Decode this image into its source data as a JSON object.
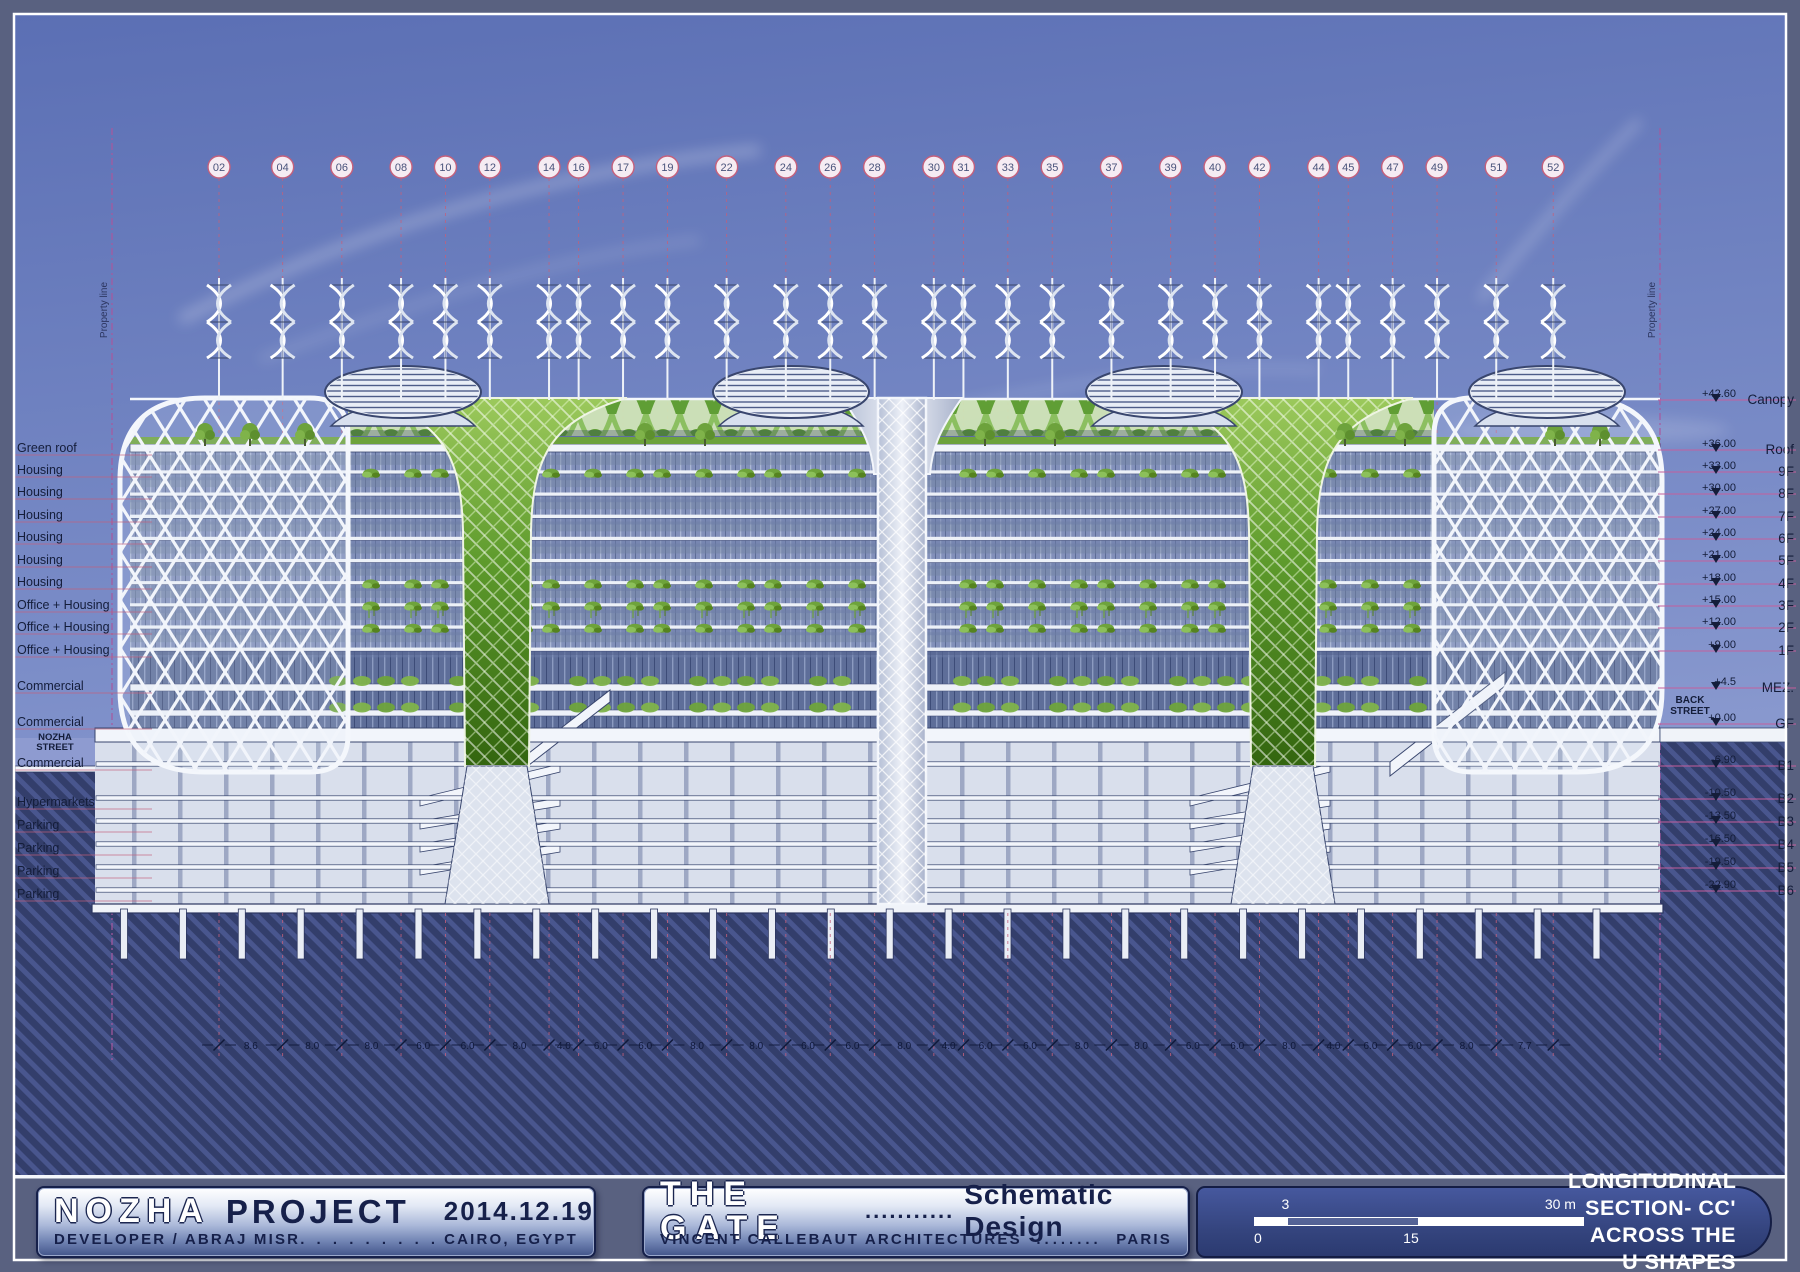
{
  "drawing": {
    "property_line": "Property line",
    "grid_bubbles": [
      "02",
      "04",
      "06",
      "08",
      "10",
      "12",
      "14",
      "16",
      "17",
      "19",
      "22",
      "24",
      "26",
      "28",
      "30",
      "31",
      "33",
      "35",
      "37",
      "39",
      "40",
      "42",
      "44",
      "45",
      "47",
      "49",
      "51",
      "52"
    ],
    "dimensions": [
      "8.6",
      "8.0",
      "8.0",
      "6.0",
      "6.0",
      "8.0",
      "4.0",
      "6.0",
      "6.0",
      "8.0",
      "8.0",
      "6.0",
      "6.0",
      "8.0",
      "4.0",
      "6.0",
      "6.0",
      "8.0",
      "8.0",
      "6.0",
      "6.0",
      "8.0",
      "4.0",
      "6.0",
      "6.0",
      "8.0",
      "7.7"
    ],
    "left_labels": [
      {
        "text": "Green roof",
        "y": 449
      },
      {
        "text": "Housing",
        "y": 471
      },
      {
        "text": "Housing",
        "y": 493
      },
      {
        "text": "Housing",
        "y": 516
      },
      {
        "text": "Housing",
        "y": 538
      },
      {
        "text": "Housing",
        "y": 561
      },
      {
        "text": "Housing",
        "y": 583
      },
      {
        "text": "Office + Housing",
        "y": 606
      },
      {
        "text": "Office + Housing",
        "y": 628
      },
      {
        "text": "Office + Housing",
        "y": 651
      },
      {
        "text": "Commercial",
        "y": 687
      },
      {
        "text": "Commercial",
        "y": 723
      },
      {
        "text": "Commercial",
        "y": 764
      },
      {
        "text": "Hypermarkets",
        "y": 803
      },
      {
        "text": "Parking",
        "y": 826
      },
      {
        "text": "Parking",
        "y": 849
      },
      {
        "text": "Parking",
        "y": 872
      },
      {
        "text": "Parking",
        "y": 895
      }
    ],
    "nozha_street": [
      "NOZHA",
      "STREET"
    ],
    "back_street": [
      "BACK",
      "STREET"
    ],
    "right_levels": [
      {
        "elev": "+42.60",
        "label": "Canopy",
        "y": 400
      },
      {
        "elev": "+36.00",
        "label": "Roof",
        "y": 450
      },
      {
        "elev": "+33.00",
        "label": "9F",
        "y": 472
      },
      {
        "elev": "+30.00",
        "label": "8F",
        "y": 494
      },
      {
        "elev": "+27.00",
        "label": "7F",
        "y": 517
      },
      {
        "elev": "+24.00",
        "label": "6F",
        "y": 539
      },
      {
        "elev": "+21.00",
        "label": "5F",
        "y": 561
      },
      {
        "elev": "+18.00",
        "label": "4F",
        "y": 584
      },
      {
        "elev": "+15.00",
        "label": "3F",
        "y": 606
      },
      {
        "elev": "+12.00",
        "label": "2F",
        "y": 628
      },
      {
        "elev": "+9.00",
        "label": "1F",
        "y": 651
      },
      {
        "elev": "+4.5",
        "label": "MEZ.",
        "y": 688
      },
      {
        "elev": "+0.00",
        "label": "GF",
        "y": 724
      },
      {
        "elev": "-6.90",
        "label": "B1",
        "y": 766
      },
      {
        "elev": "-10.50",
        "label": "B2",
        "y": 799
      },
      {
        "elev": "-13.50",
        "label": "B3",
        "y": 822
      },
      {
        "elev": "-16.50",
        "label": "B4",
        "y": 845
      },
      {
        "elev": "-19.50",
        "label": "B5",
        "y": 868
      },
      {
        "elev": "-22.90",
        "label": "B6",
        "y": 891
      }
    ]
  },
  "title_block": {
    "project": {
      "name_outline": "NOZHA",
      "name_solid": "PROJECT",
      "date": "2014.12.19",
      "line2_left": "DEVELOPER / ABRAJ MISR",
      "line2_dots": ". . . . . . . . . . . . . . . . .",
      "line2_right": "CAIRO, EGYPT"
    },
    "design": {
      "name_outline": "THE GATE",
      "dots": "...........",
      "name_solid": "Schematic Design",
      "line2_left": "VINCENT CALLEBAUT ARCHITECTURES",
      "line2_dots": "........",
      "line2_right": "PARIS"
    },
    "section": {
      "scale_top_left": "3",
      "scale_top_right": "30 m",
      "scale_bottom_left": "0",
      "scale_bottom_mid": "15",
      "title_line1": "LONGITUDINAL SECTION- CC'",
      "title_line2": "ACROSS THE U SHAPES"
    }
  },
  "colors": {
    "sky_top": "#5b6fb4",
    "sky_bottom": "#97a4d6",
    "ground": "#333e6b",
    "ground_stripe": "#4d5b94",
    "grid_pink": "#c4607c",
    "level_magenta": "#c45f9d",
    "green_dark": "#4f8a24",
    "green_light": "#8dc25c",
    "structure_white": "#f2f5fb",
    "text_navy": "#141d3a"
  }
}
